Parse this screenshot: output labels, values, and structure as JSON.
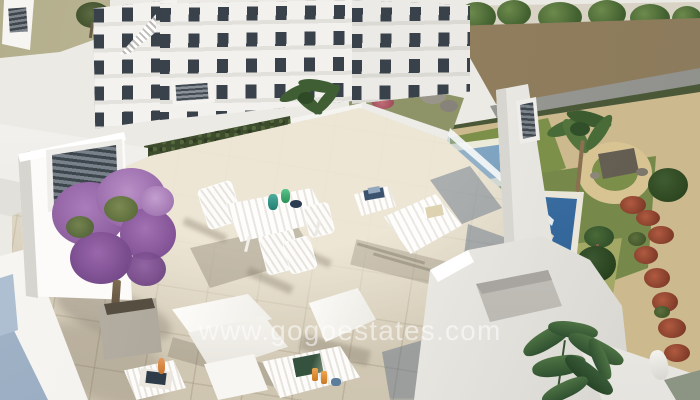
{
  "watermark": {
    "text": "www.gogoestates.com"
  },
  "palette": {
    "wall_white": "#f2f1ee",
    "terrace_tile": "#d9d1bf",
    "shadow_blue_grey": "#6b7d93",
    "bougainvillea_purple": "#9b6fae",
    "lawn_green": "#7c8f4a",
    "pool_blue": "#35689c",
    "sand_path": "#cdb98e",
    "dirt_lot": "#937f5e",
    "tree_green": "#4a6a38",
    "car_orange": "#e08b2f",
    "louver_grey": "#434b52",
    "lower_roof_blue": "#9fb3c8"
  }
}
